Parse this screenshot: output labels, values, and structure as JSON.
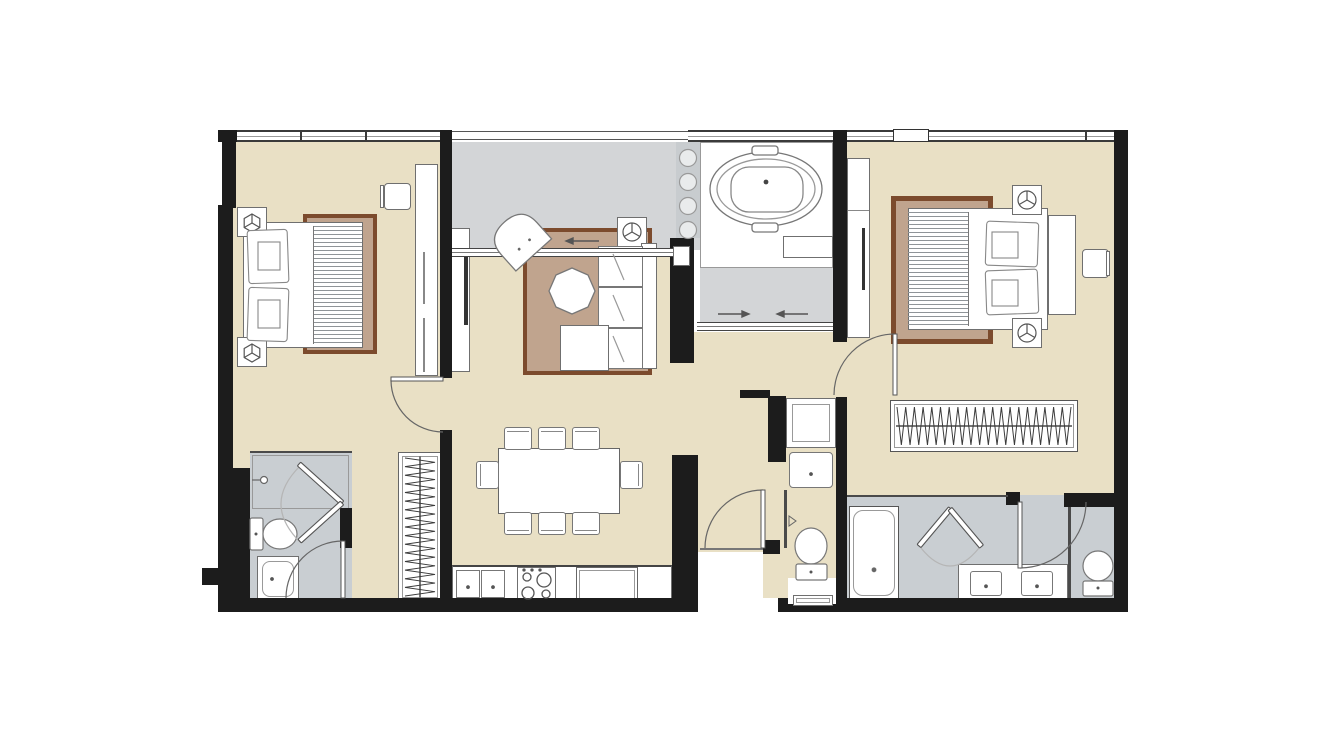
{
  "document": {
    "type": "architectural floor plan",
    "subject": "two-bedroom two-bathroom apartment unit, top-down furnished view",
    "visible_text": []
  },
  "colors": {
    "beige": "#e9e0c5",
    "balconyGray": "#d3d5d7",
    "pebbleGray": "#c8cccf",
    "bathGray": "#c9ced2",
    "wall": "#1c1c1c",
    "line": "#6f6f6f",
    "thin": "#4a4a4a",
    "rugBorder": "#7c4b2d",
    "rugFill": "#c0a48e"
  },
  "rooms": [
    {
      "name": "bedroom-2",
      "floor": "beige",
      "fixtures": [
        "double bed with striped blanket",
        "area rug",
        "2 pillows",
        "2 nightstands with lamp symbol",
        "stool",
        "built-in closet",
        "hinged door",
        "window wall"
      ]
    },
    {
      "name": "ensuite-bathroom-2",
      "floor": "gray",
      "fixtures": [
        "shower with bifold door and shower head",
        "toilet",
        "washbasin",
        "hinged door"
      ]
    },
    {
      "name": "dressing-nook",
      "floor": "beige",
      "fixtures": [
        "open hanger wardrobe"
      ]
    },
    {
      "name": "living-room",
      "floor": "beige",
      "fixtures": [
        "3-seat sofa",
        "chaise ottoman",
        "armchair",
        "octagonal side table",
        "area rug",
        "tv console",
        "ceiling lamp symbol"
      ]
    },
    {
      "name": "dining-kitchen",
      "floor": "beige",
      "fixtures": [
        "dining table",
        "8 chairs",
        "kitchen counter",
        "double sink",
        "4-burner hob",
        "refrigerator"
      ]
    },
    {
      "name": "balcony",
      "floor": "gray",
      "fixtures": [
        "sliding glass door with direction arrows",
        "railing"
      ]
    },
    {
      "name": "bath-terrace",
      "floor": "white deck",
      "fixtures": [
        "oval bathtub on platform",
        "pebble strip with stones",
        "counter ledge",
        "sliding glass door with direction arrows"
      ]
    },
    {
      "name": "hallway-vanity",
      "floor": "beige",
      "fixtures": [
        "washbasin cabinet",
        "hand sink",
        "mirror panel"
      ]
    },
    {
      "name": "wc",
      "floor": "beige",
      "fixtures": [
        "toilet",
        "storage niche with tray"
      ]
    },
    {
      "name": "master-bedroom",
      "floor": "beige",
      "fixtures": [
        "double bed with striped blanket",
        "area rug",
        "2 pillows",
        "headboard",
        "2 nightstands with lamp symbol",
        "stool",
        "tv cabinet",
        "open hanger wardrobe",
        "hinged door",
        "window wall"
      ]
    },
    {
      "name": "master-bathroom",
      "floor": "gray",
      "fixtures": [
        "bathtub-shower",
        "bifold shower door",
        "double vanity with 2 sinks",
        "toilet compartment",
        "hinged door"
      ]
    },
    {
      "name": "entry",
      "floor": "recessed",
      "fixtures": [
        "entry door with swing arc",
        "threshold"
      ]
    }
  ]
}
